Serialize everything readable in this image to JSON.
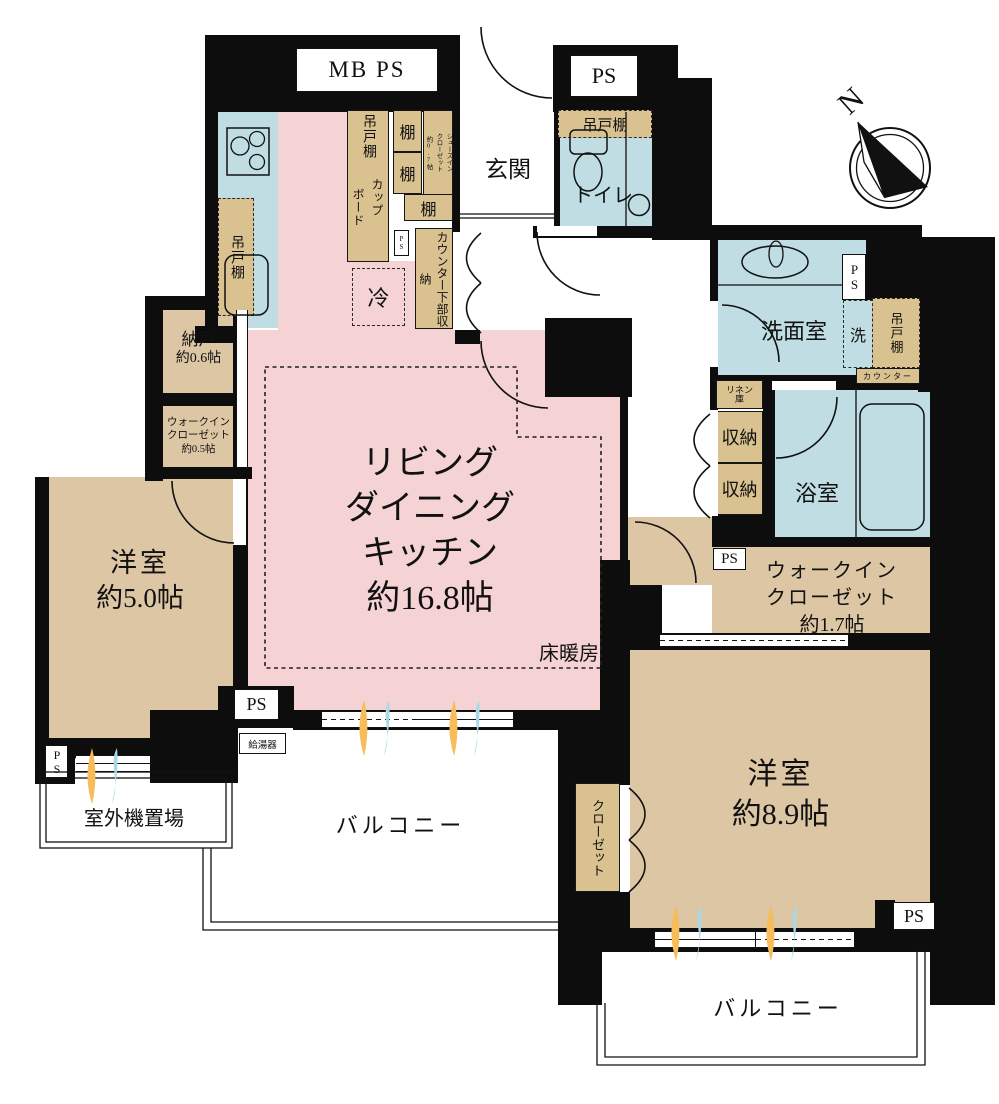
{
  "colors": {
    "wall": "#0d0d0d",
    "pink": "#f5d3d5",
    "tan": "#ddc6a4",
    "stor": "#d9c28f",
    "blue": "#bfdde2",
    "orange": "#f6bd5a",
    "lblue": "#a9d9e8"
  },
  "compass": {
    "north": "N"
  },
  "rooms": {
    "ldk": {
      "label_lines": [
        "リビング",
        "ダイニング",
        "キッチン",
        "約16.8帖"
      ],
      "floor_heating": "床暖房"
    },
    "bedroom_5": {
      "label_lines": [
        "洋室",
        "約5.0帖"
      ]
    },
    "bedroom_89": {
      "label_lines": [
        "洋室",
        "約8.9帖"
      ]
    },
    "entrance": "玄関",
    "toilet": "トイレ",
    "washroom": "洗面室",
    "bathroom": "浴室",
    "storeroom": [
      "納戸",
      "約0.6帖"
    ],
    "wic_05": [
      "ウォークイン",
      "クローゼット",
      "約0.5帖"
    ],
    "wic_17": [
      "ウォークイン",
      "クローゼット",
      "約1.7帖"
    ],
    "balcony": "バルコニー",
    "outdoor_unit_area": "室外機置場"
  },
  "fixtures": {
    "mb_ps": "MB PS",
    "ps": "PS",
    "water_heater": "給湯器",
    "refrigerator": "冷",
    "hanging_cupboard": "吊戸棚",
    "shelf": "棚",
    "shoes_closet": [
      "シューズイン",
      "クローゼット",
      "約0.7帖"
    ],
    "cupboard": [
      "カップ",
      "ボード"
    ],
    "counter_lower_storage": "カウンター下部収納",
    "washer": "洗",
    "counter": "カウンター",
    "linen": [
      "リネン",
      "庫"
    ],
    "storage": "収納",
    "closet": "クローゼット"
  }
}
